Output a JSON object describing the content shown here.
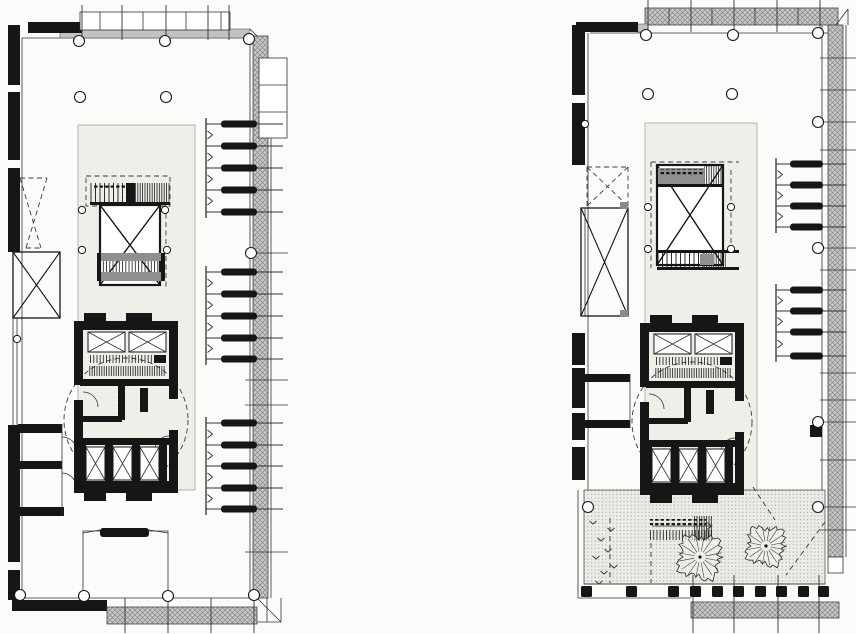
{
  "description": "Scanned page with two black-and-white architectural floor plans of a slab tower: left plan is a typical office floor, right plan is a setback floor with a planted roof terrace and two trees. No text appears on the page.",
  "palette": {
    "paper": "#fbfbf9",
    "ink": "#161616",
    "line": "#333333",
    "band_gray": "#c6c6c6",
    "wall_gray": "#c2c2c2",
    "core_fill": "#f1efe9",
    "terrace_fill": "#edebe5",
    "stair_gray": "#8f8f8f",
    "dot_gray": "#8a8a8a"
  },
  "plans": [
    {
      "id": "floor-plan-left",
      "wall": {
        "x": 8,
        "w": 12,
        "segments": [
          [
            25,
            85
          ],
          [
            92,
            160
          ],
          [
            168,
            252
          ],
          [
            425,
            562
          ],
          [
            570,
            600
          ]
        ]
      },
      "columns": {
        "r": 5.5,
        "points": [
          [
            79,
            41
          ],
          [
            165,
            41
          ],
          [
            249,
            39
          ],
          [
            80,
            97
          ],
          [
            166,
            97
          ],
          [
            251,
            253
          ],
          [
            20,
            595
          ],
          [
            84,
            596
          ],
          [
            168,
            596
          ],
          [
            254,
            595
          ]
        ]
      },
      "core_columns": {
        "r": 3.6,
        "points": [
          [
            82,
            210
          ],
          [
            82,
            250
          ],
          [
            165,
            210
          ],
          [
            167,
            250
          ],
          [
            17,
            339
          ]
        ]
      },
      "desks": {
        "spine_x": 206,
        "right_x": 283,
        "pill_x": 221,
        "pill_w": 36,
        "groups": [
          [
            124,
            146,
            168,
            190,
            212
          ],
          [
            272,
            294,
            316,
            338,
            359
          ],
          [
            423,
            445,
            466,
            488,
            509
          ]
        ]
      },
      "band_ticks": {
        "x0": 245,
        "x1": 288,
        "ys": [
          253,
          380,
          405,
          552
        ]
      },
      "top_band": {
        "y0": 12,
        "y1": 30,
        "tick_y0": 5,
        "tick_y1": 40,
        "dividers": [
          100,
          143,
          186,
          221
        ],
        "long_ticks": [
          82,
          122,
          166,
          208,
          229
        ]
      },
      "bottom_ticks": {
        "y0": 598,
        "y1": 633,
        "xs": [
          125,
          168,
          211,
          254
        ]
      },
      "dashed_lines": []
    },
    {
      "id": "floor-plan-right",
      "wall": {
        "x": 572,
        "w": 13,
        "segments": [
          [
            25,
            95
          ],
          [
            103,
            165
          ],
          [
            333,
            365
          ],
          [
            368,
            408
          ],
          [
            413,
            440
          ],
          [
            447,
            480
          ]
        ]
      },
      "columns": {
        "r": 5.5,
        "points": [
          [
            646,
            35
          ],
          [
            733,
            35
          ],
          [
            818,
            33
          ],
          [
            648,
            94
          ],
          [
            732,
            94
          ],
          [
            818,
            122
          ],
          [
            818,
            248
          ],
          [
            818,
            422
          ],
          [
            588,
            507
          ],
          [
            818,
            507
          ]
        ]
      },
      "core_columns": {
        "r": 3.6,
        "points": [
          [
            648,
            207
          ],
          [
            648,
            249
          ],
          [
            731,
            207
          ],
          [
            731,
            249
          ],
          [
            585,
            124
          ]
        ]
      },
      "desks": {
        "spine_x": 776,
        "right_x": 846,
        "pill_x": 790,
        "pill_w": 33,
        "groups": [
          [
            164,
            185,
            206,
            227
          ],
          [
            290,
            311,
            332,
            356
          ]
        ]
      },
      "band_ticks": {
        "x0": 820,
        "x1": 856,
        "ys": [
          58,
          90,
          122,
          150,
          248,
          270,
          373,
          400,
          422,
          460,
          507,
          530
        ]
      },
      "top_band": {
        "y0": 8,
        "y1": 25,
        "tick_y0": 0,
        "tick_y1": 32,
        "dividers": [
          669,
          712,
          755,
          798
        ],
        "long_ticks": [
          648,
          691,
          734,
          777,
          820
        ]
      },
      "bottom_ticks": {
        "y0": 575,
        "y1": 633,
        "xs": [
          693,
          734,
          778,
          819
        ]
      },
      "planters": {
        "y": 586,
        "size": 11,
        "xs": [
          581,
          626,
          668,
          690,
          712,
          733,
          755,
          776,
          798,
          818
        ]
      },
      "trees": [
        {
          "cx": 700,
          "cy": 557,
          "r": 28
        },
        {
          "cx": 766,
          "cy": 546,
          "r": 25
        }
      ],
      "v_marks": [
        [
          593,
          524
        ],
        [
          601,
          541
        ],
        [
          596,
          559
        ],
        [
          604,
          574
        ],
        [
          611,
          531
        ],
        [
          608,
          552
        ],
        [
          614,
          568
        ],
        [
          599,
          584
        ]
      ],
      "dashed_lines": [
        [
          651,
          543,
          651,
          583
        ],
        [
          610,
          518,
          610,
          583
        ],
        [
          825,
          522,
          786,
          575
        ],
        [
          753,
          487,
          775,
          520
        ]
      ]
    }
  ]
}
